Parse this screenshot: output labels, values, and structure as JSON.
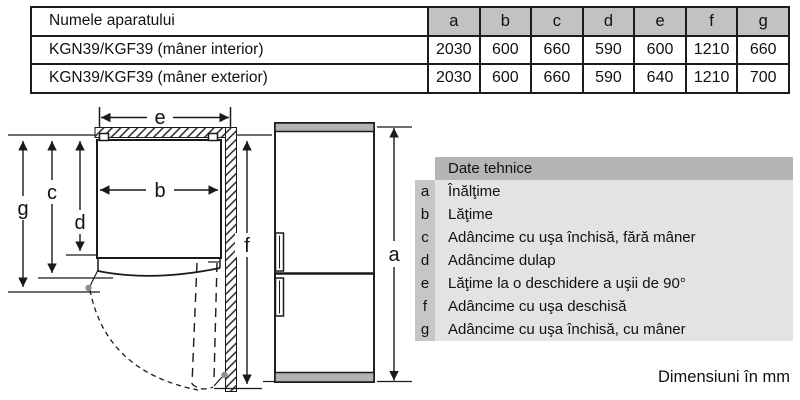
{
  "table": {
    "name_header": "Numele aparatului",
    "dim_headers": [
      "a",
      "b",
      "c",
      "d",
      "e",
      "f",
      "g"
    ],
    "rows": [
      {
        "name": "KGN39/KGF39 (mâner interior)",
        "values": [
          "2030",
          "600",
          "660",
          "590",
          "600",
          "1210",
          "660"
        ]
      },
      {
        "name": "KGN39/KGF39 (mâner exterior)",
        "values": [
          "2030",
          "600",
          "660",
          "590",
          "640",
          "1210",
          "700"
        ]
      }
    ]
  },
  "legend": {
    "title": "Date tehnice",
    "items": [
      {
        "key": "a",
        "label": "Înălţime"
      },
      {
        "key": "b",
        "label": "Lăţime"
      },
      {
        "key": "c",
        "label": "Adâncime cu uşa închisă, fără mâner"
      },
      {
        "key": "d",
        "label": "Adâncime dulap"
      },
      {
        "key": "e",
        "label": "Lăţime la o deschidere a uşii de 90°"
      },
      {
        "key": "f",
        "label": "Adâncime cu uşa deschisă"
      },
      {
        "key": "g",
        "label": "Adâncime cu uşa închisă, cu mâner"
      }
    ]
  },
  "diagram": {
    "top_view": {
      "label_e": "e",
      "label_b": "b",
      "label_c": "c",
      "label_d": "d",
      "label_g": "g",
      "label_f": "f"
    },
    "front_view": {
      "label_a": "a"
    }
  },
  "footer": {
    "units_note": "Dimensiuni în mm"
  },
  "colors": {
    "table_header_bg": "#c2c2c2",
    "legend_header_bg": "#b5b5b5",
    "legend_key_bg": "#c6c6c6",
    "legend_row_bg": "#e3e3e3",
    "fridge_cap_bg": "#b3b3b3",
    "pivot_dot": "#8e8e8e",
    "line": "#1a1a1a"
  }
}
